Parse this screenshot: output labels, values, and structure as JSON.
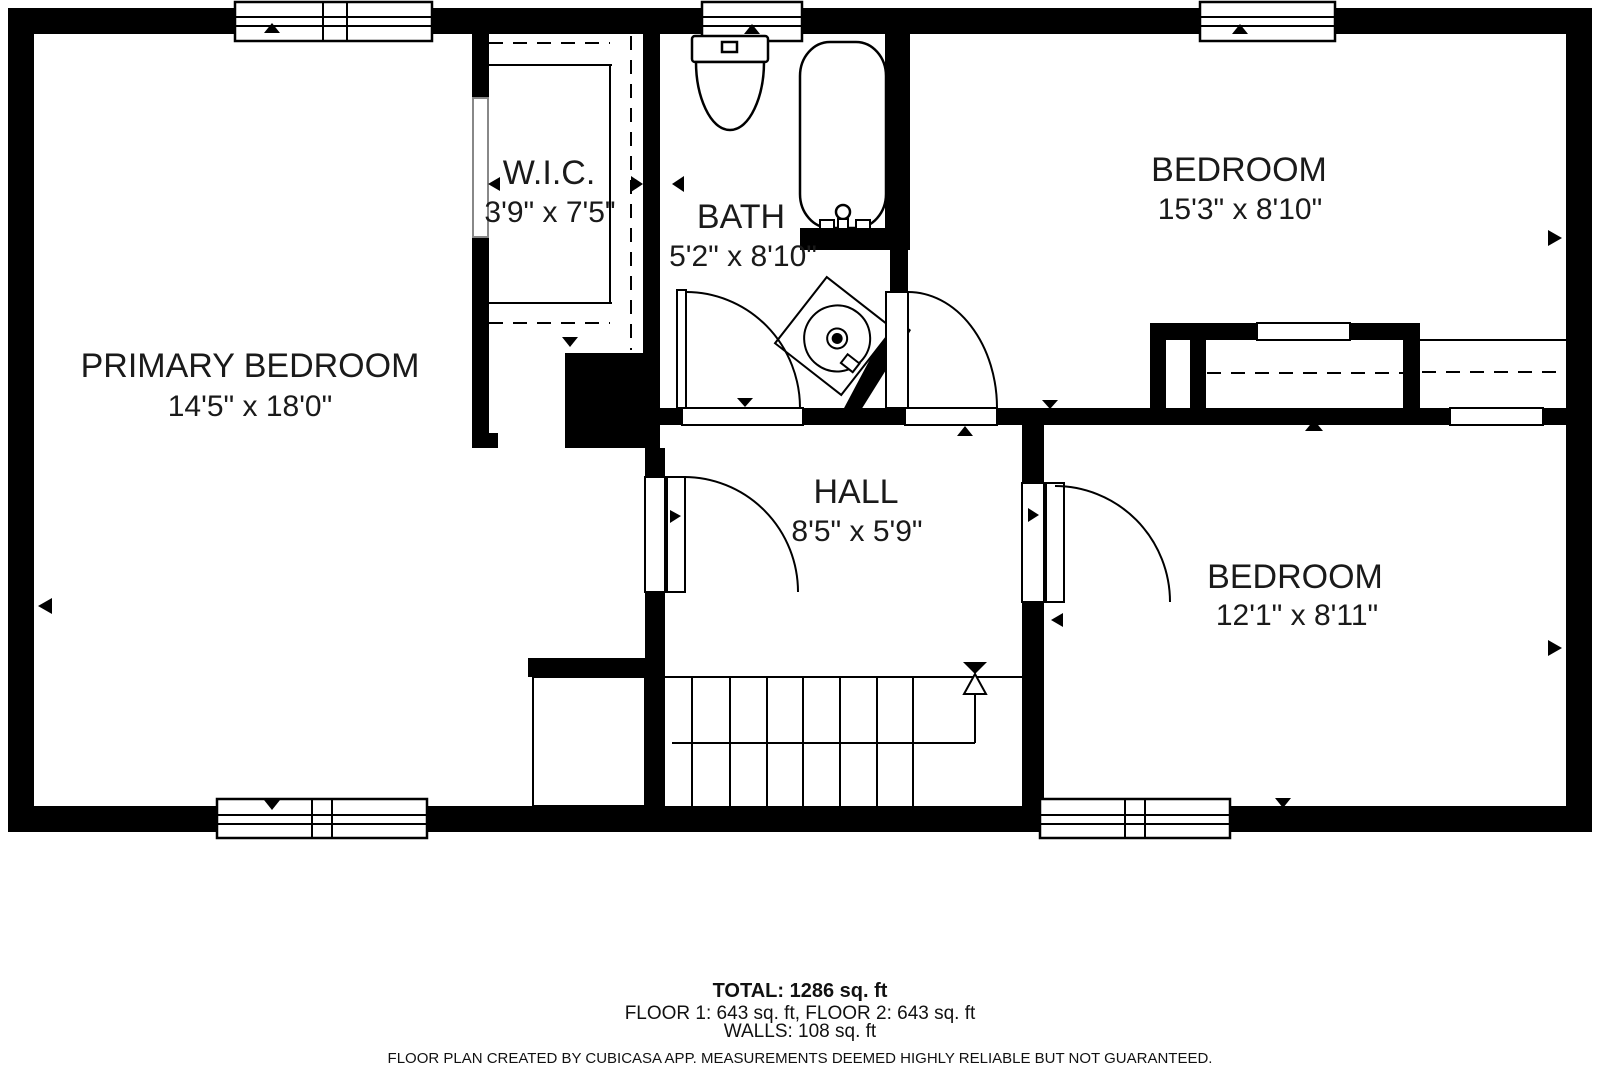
{
  "plan": {
    "rooms": [
      {
        "name": "PRIMARY BEDROOM",
        "dims": "14'5\" x 18'0\""
      },
      {
        "name": "W.I.C.",
        "dims": "3'9\" x 7'5\""
      },
      {
        "name": "BATH",
        "dims": "5'2\" x 8'10\""
      },
      {
        "name": "BEDROOM",
        "dims": "15'3\" x 8'10\""
      },
      {
        "name": "HALL",
        "dims": "8'5\" x 5'9\""
      },
      {
        "name": "BEDROOM",
        "dims": "12'1\" x 8'11\""
      }
    ],
    "colors": {
      "wall": "#000000",
      "floor": "#ffffff",
      "text": "#1a1a1a"
    }
  },
  "footer": {
    "total": "TOTAL: 1286 sq. ft",
    "floors": "FLOOR 1: 643 sq. ft, FLOOR 2: 643 sq. ft",
    "walls": "WALLS: 108 sq. ft",
    "disclaimer": "FLOOR PLAN CREATED BY CUBICASA APP. MEASUREMENTS DEEMED HIGHLY RELIABLE BUT NOT GUARANTEED."
  }
}
